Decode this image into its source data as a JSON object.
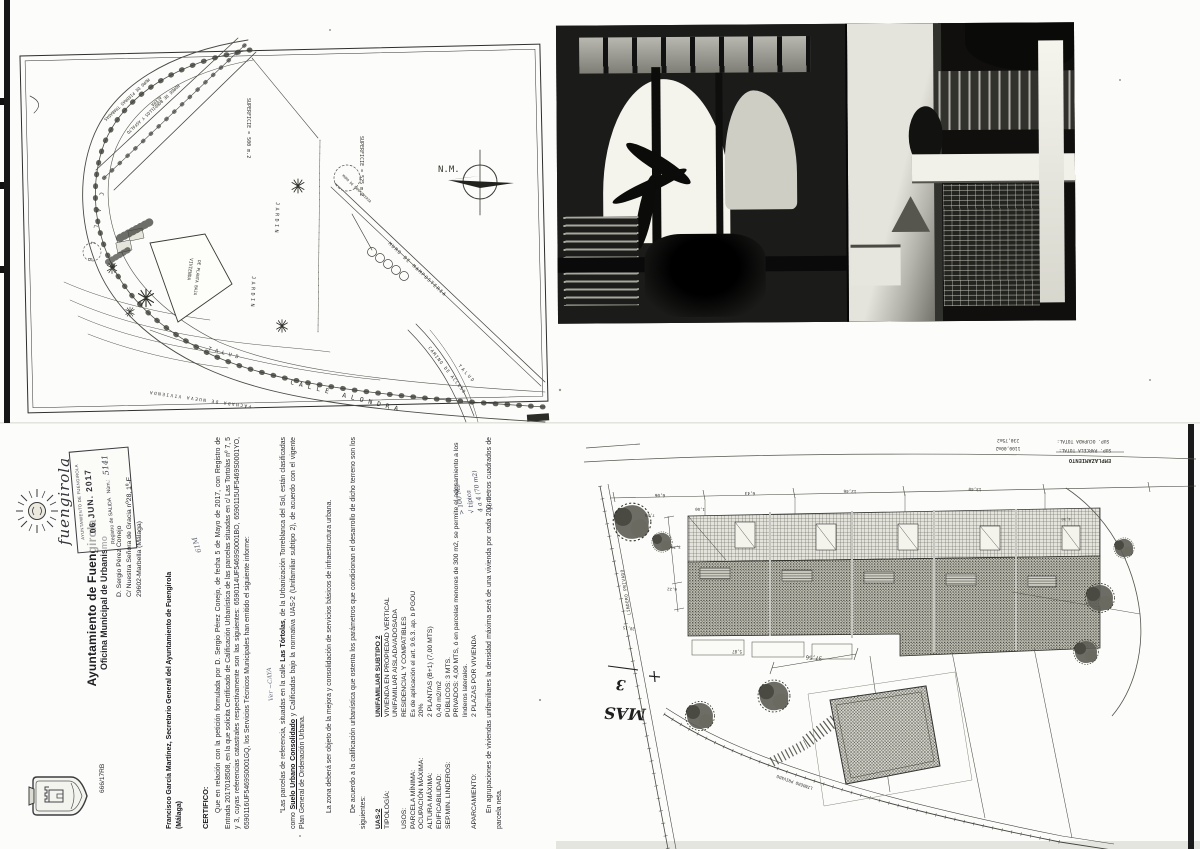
{
  "colors": {
    "ink": "#2b2b31",
    "paper": "#fcfcfa",
    "scan_edge": "#161616"
  },
  "survey_map": {
    "labels": {
      "north_mark": "N.M.",
      "superficie_500": "SUPERFICIE = 500 m.2",
      "superficie_525": "SUPERFICIE = 525 m.2",
      "calle": "C A L L E",
      "calle_alondra": "CALLE ALONDRA",
      "talud_1": "TALUD",
      "talud_2": "TALUD",
      "jardin_1": "JARDIN",
      "jardin_2": "JARDIN",
      "vivienda_line1": "VIVIENDA",
      "vivienda_line2": "DE PLANTA BAJA",
      "muro_mamposteria_1": "MURO DE MAMPOSTERIA",
      "muro_mamposteria_2": "MURO DE MAMPOSTERIA",
      "muro_piedras": "MURO DE PIEDRAS TRABADAS",
      "acera": "ACERA",
      "borde_bordillos": "BORDE DE BORDILLOS Y ASFALTO",
      "camino_acceso": "CAMINO DE ACCESO",
      "fachada": "FACHADA DE NUEVA VIVIENDA"
    }
  },
  "letter": {
    "ref": "666/17RB",
    "org_name": "Ayuntamiento de Fuengirola",
    "org_dept": "Oficina Municipal de Urbanismo",
    "logo_wordmark": "fuengirola",
    "stamp": {
      "header": "AYUNTAMIENTO DE FUENGIROLA",
      "date": "06 JUN. 2017",
      "registry": "Registro de SALIDA",
      "num_label": "Núm.:",
      "num_value": "5141"
    },
    "addressee": {
      "line1": "D. Sergio Pérez Conejo",
      "line2": "C/ Nuestra Señora de Gracia nº28, 1º-E",
      "line3": "29602-Marbella (Málaga)"
    },
    "margin_mark": "61M",
    "from_line1": "Francisco García Martínez, Secretario General del Ayuntamiento de Fuengirola",
    "from_line2": "(Málaga)",
    "certify_heading": "CERTIFICO:",
    "para1": "Que en relación con la petición formulada por D. Sergio Pérez Conejo, de fecha 5 de Mayo de 2017, con Registro de Entrada 2017018508, en la que solicita Certificado de Calificación Urbanística de las parcelas situadas en c/ Las Tortolas nº 7, 5 y 3, cuyas referencias catastrales respectivamente son las siguientes: 6590114UF5469S0001BO, 6590115UF5469S0001YO, 6590116UF5469S0001GQ, los Servicios Técnicos Municipales han emitido el siguiente informe:",
    "scribble": "Ver ~CAYA",
    "para2": {
      "a": "“Las parcelas de referencia, situadas en la calle ",
      "b": "Las Tórtolas",
      "c": ", de la Urbanización Torreblanca del Sol, están clasificadas como ",
      "d": "Suelo Urbano Consolidado",
      "e": " y Calificadas bajo la normativa UAS-2 (Unifamiliar subtipo 2), de acuerdo con el vigente Plan General de Ordenación Urbana."
    },
    "para3": "La zona deberá ser objeto de la mejora y consolidación de servicios básicos de infraestructura urbana.",
    "para4": "De acuerdo a la calificación urbanística que ostenta los parámetros que condicionan el desarrollo de dicho terreno son los siguientes:",
    "spec": {
      "code": "UAS-2",
      "code_value": "UNIFAMILIAR SUBTIPO 2",
      "rows": [
        {
          "label": "TIPOLOGÍA:",
          "value": "VIVIENDA EN PROPIEDAD VERTICAL"
        },
        {
          "label": "",
          "value": "UNIFAMILIAR AISLADA/ADOSADA"
        },
        {
          "label": "USOS:",
          "value": "RESIDENCIAL Y COMPATIBLES"
        },
        {
          "label": "PARCELA MÍNIMA:",
          "value": "Es de aplicación el art. 9.6.3. ap. b PGOU"
        },
        {
          "label": "OCUPACIÓN MÁXIMA:",
          "value": "20%"
        },
        {
          "label": "ALTURA MÁXIMA:",
          "value": "2 PLANTAS (B+1) (7,00 MTS)"
        },
        {
          "label": "EDIFICABILIDAD:",
          "value": "0,40 m2/m2"
        },
        {
          "label": "SEP.MIN. LINDEROS:",
          "value": "PÚBLICOS: 3 MTS."
        },
        {
          "label": "",
          "value": "PRIVADOS: 4,00 MTS, ó en parcelas menores de 300 m2, se permite el adosamiento a los linderos laterales."
        },
        {
          "label": "APARCAMIENTO:",
          "value": "2 PLAZAS POR VIVIENDA"
        }
      ]
    },
    "notes": {
      "n1": "> 100 M2",
      "n2": "√ típica",
      "n3": "4 a 4 (70 m2)",
      "n4": "16-2"
    },
    "final_para": "En agrupaciones de viviendas unifamiliares la densidad máxima será de una vivienda por cada 200 metros cuadrados de parcela neta."
  },
  "site_plan": {
    "title_block": {
      "title": "EMPLAZAMIENTO",
      "parcela_label": "SUP. PARCELA TOTAL:",
      "parcela_value": "1100,00m2",
      "ocupada_label": "SUP. OCUPADA TOTAL:",
      "ocupada_value": "230,75m2"
    },
    "labels": {
      "lindero_1": "LINDERO PRIVADO",
      "lindero_2": "LINDERO PRIVADO"
    },
    "dims": {
      "d3756": "37,56",
      "top": [
        "6,06",
        "6,43",
        "12,46",
        "13,40"
      ],
      "left": [
        "7,20",
        "1,00",
        "3,76",
        "6,22"
      ],
      "misc": [
        "20,15",
        "5,87",
        "4,50"
      ]
    },
    "handwriting": {
      "mas": "MAS",
      "num": "3"
    }
  }
}
